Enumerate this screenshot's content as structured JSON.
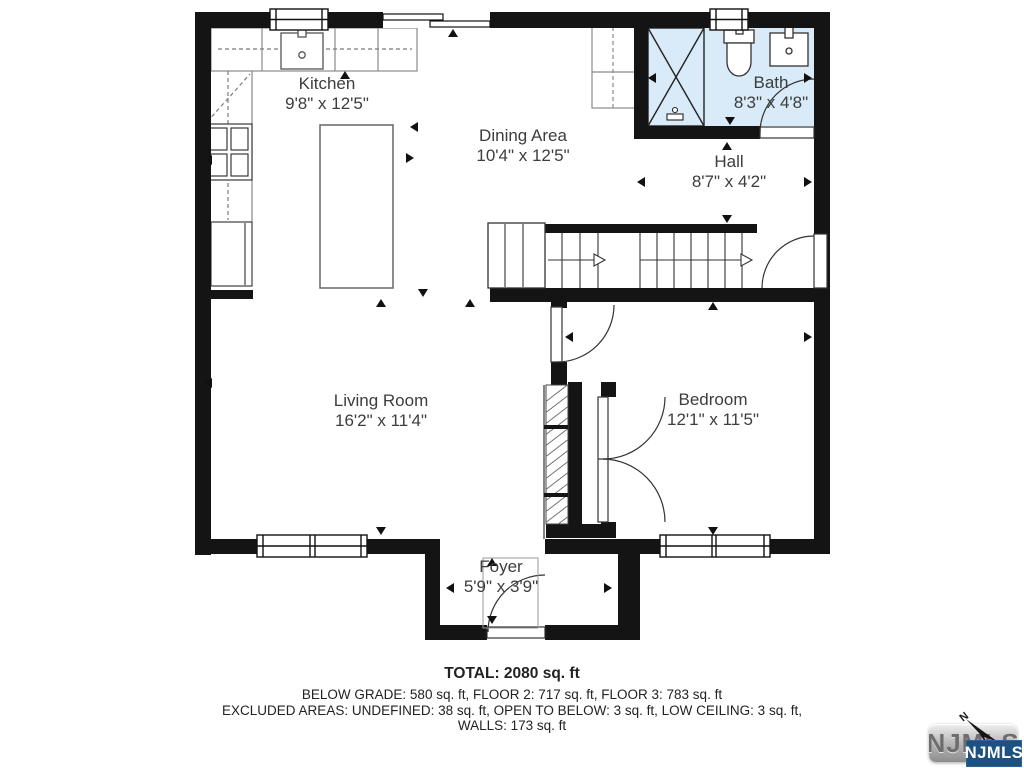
{
  "rooms": [
    {
      "name": "Kitchen",
      "dims": "9'8\" x 12'5\""
    },
    {
      "name": "Dining Area",
      "dims": "10'4\" x 12'5\""
    },
    {
      "name": "Bath",
      "dims": "8'3\" x 4'8\""
    },
    {
      "name": "Hall",
      "dims": "8'7\" x 4'2\""
    },
    {
      "name": "Living Room",
      "dims": "16'2\" x 11'4\""
    },
    {
      "name": "Bedroom",
      "dims": "12'1\" x 11'5\""
    },
    {
      "name": "Foyer",
      "dims": "5'9\" x 3'9\""
    }
  ],
  "summary": {
    "total": "TOTAL: 2080 sq. ft",
    "floors": "BELOW GRADE: 580 sq. ft, FLOOR 2: 717 sq. ft, FLOOR 3: 783 sq. ft",
    "excluded": "EXCLUDED AREAS: UNDEFINED: 38 sq. ft, OPEN TO BELOW: 3 sq. ft, LOW CEILING: 3 sq. ft,",
    "walls": "WALLS: 173 sq. ft"
  },
  "logo": {
    "badge": "NJMLS",
    "watermark": "NJMLS",
    "compass_n": "N"
  },
  "colors": {
    "wall": "#141414",
    "bath_fill": "#d9ebf8",
    "logo_blue": "#1d5180",
    "line_gray": "#6b6b6b"
  }
}
